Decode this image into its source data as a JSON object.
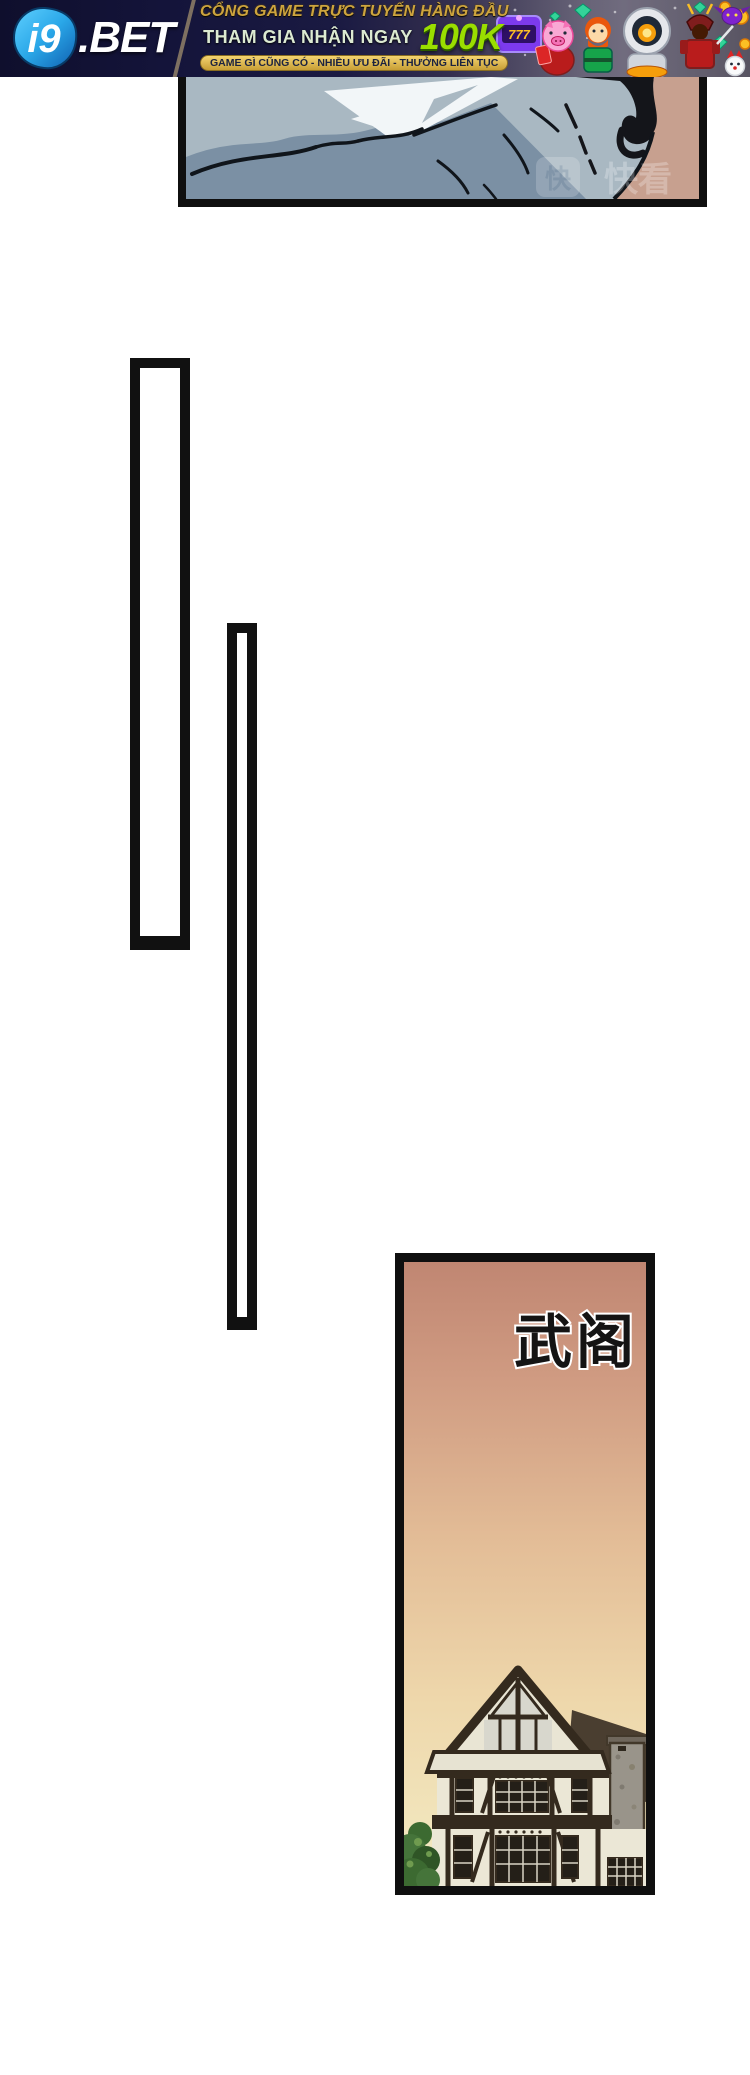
{
  "banner": {
    "logo": {
      "i9": "i9",
      "bet": ".BET"
    },
    "headline": "CỔNG GAME TRỰC TUYẾN HÀNG ĐẦU",
    "subline_prefix": "THAM GIA NHẬN NGAY",
    "subline_amount": "100K",
    "pill": "GAME GÌ CŨNG CÓ - NHIỀU ƯU ĐÃI - THƯỞNG LIÊN TỤC",
    "slot_text": "777",
    "colors": {
      "gold": "#cda43e",
      "bright_green": "#9ade00",
      "navy": "#10102d",
      "pill_bg": "#e7bb4f",
      "logo_blue": "#2aa7e8"
    }
  },
  "comic": {
    "top_panel": {
      "watermark_icon": "快",
      "watermark_text": "快看"
    },
    "bottom_panel": {
      "label": "武阁"
    },
    "colors": {
      "panel_border": "#0f0f0f",
      "fabric_light": "#a9b8c2",
      "fabric_dark": "#7b90a4",
      "skin": "#c7a08f",
      "sunset_top": "#c08672",
      "sunset_bottom": "#f3ebc3"
    }
  }
}
